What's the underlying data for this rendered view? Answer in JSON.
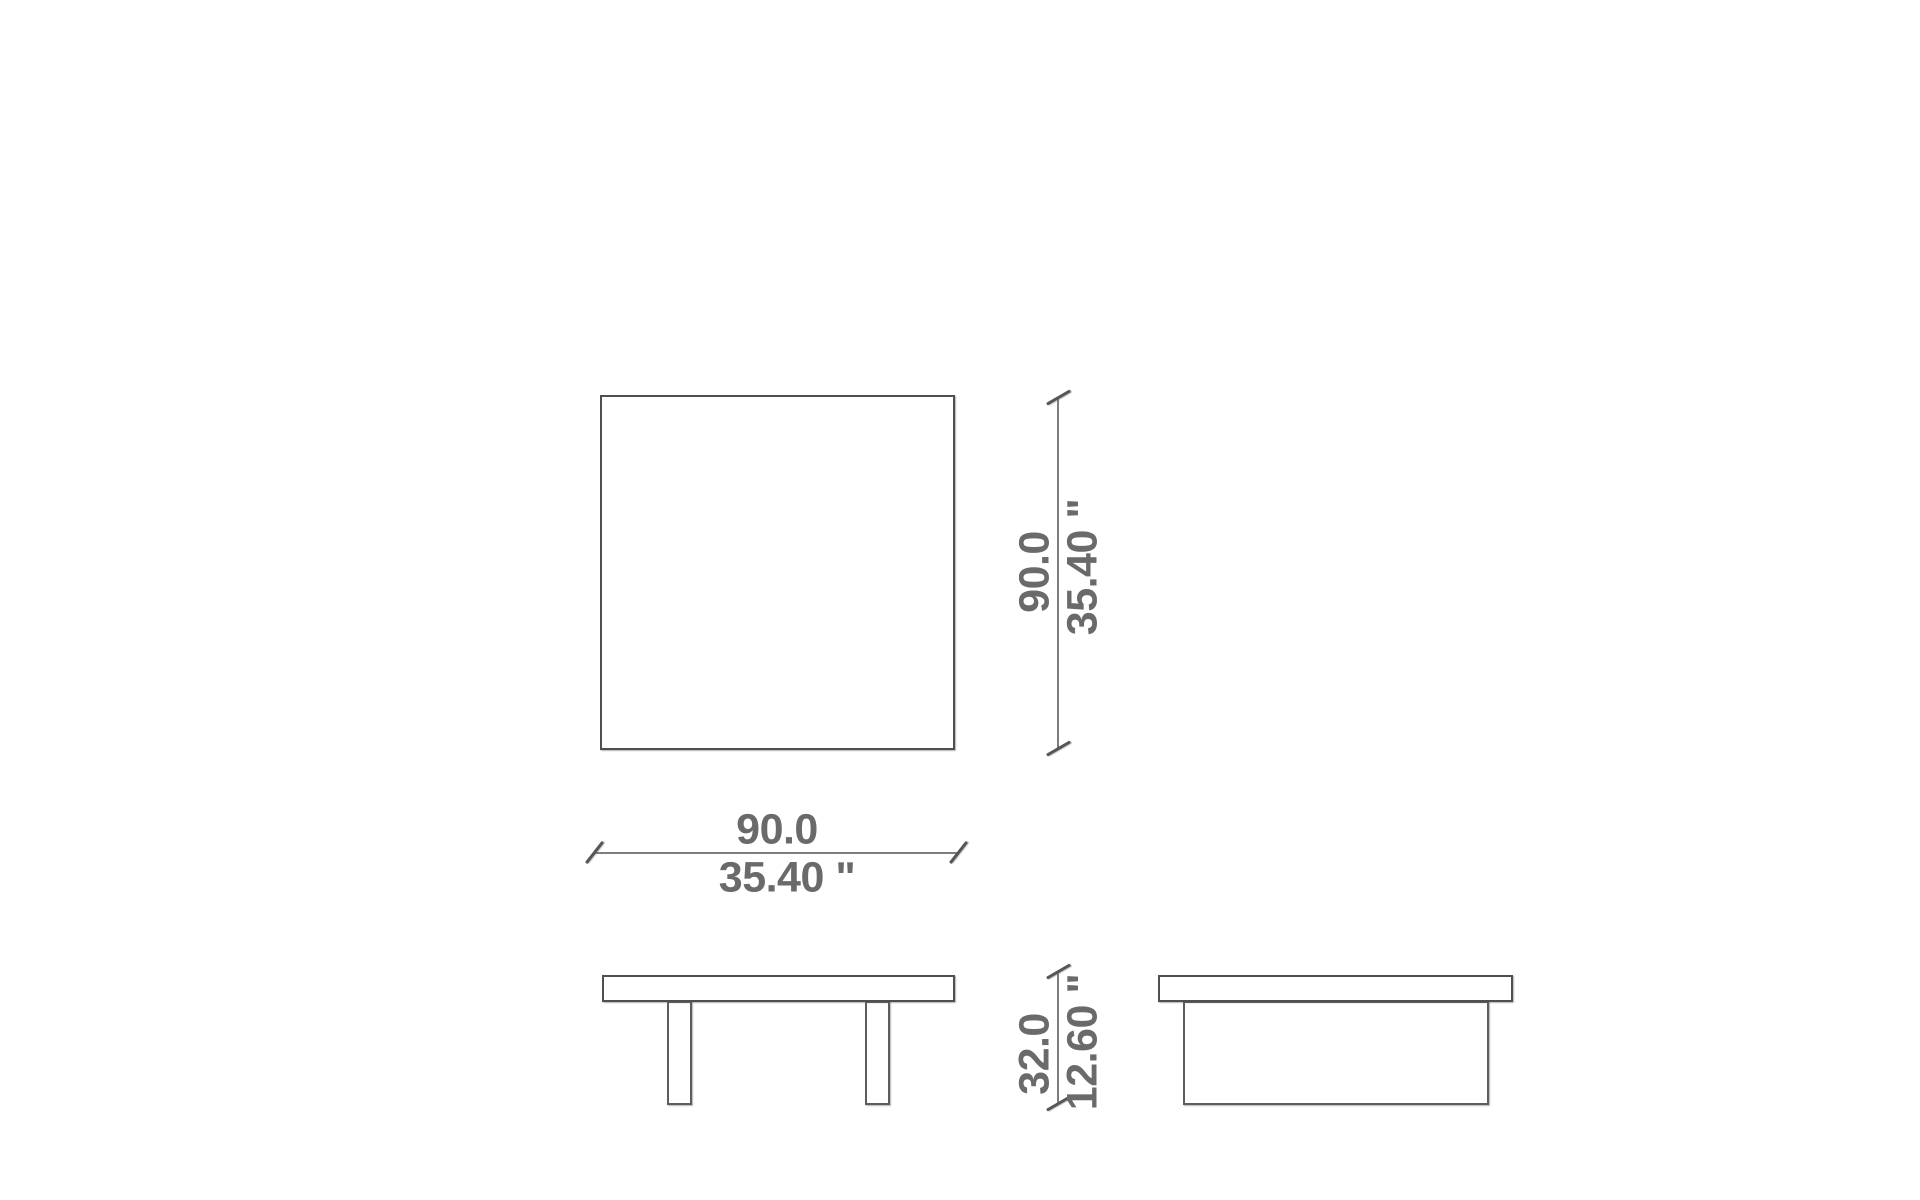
{
  "drawing": {
    "type": "furniture-dimension-drawing",
    "views": [
      "top-view",
      "front-view",
      "side-view"
    ]
  },
  "dimensions": {
    "width": {
      "cm": "90.0",
      "inches": "35.40 \""
    },
    "depth": {
      "cm": "90.0",
      "inches": "35.40 \""
    },
    "height": {
      "cm": "32.0",
      "inches": "12.60 \""
    }
  },
  "colors": {
    "background": "#ffffff",
    "outline": "#4f4f4f",
    "dimension_line": "#7d7d7d",
    "tick_mark": "#565656",
    "label_text": "#6a6a6a"
  }
}
